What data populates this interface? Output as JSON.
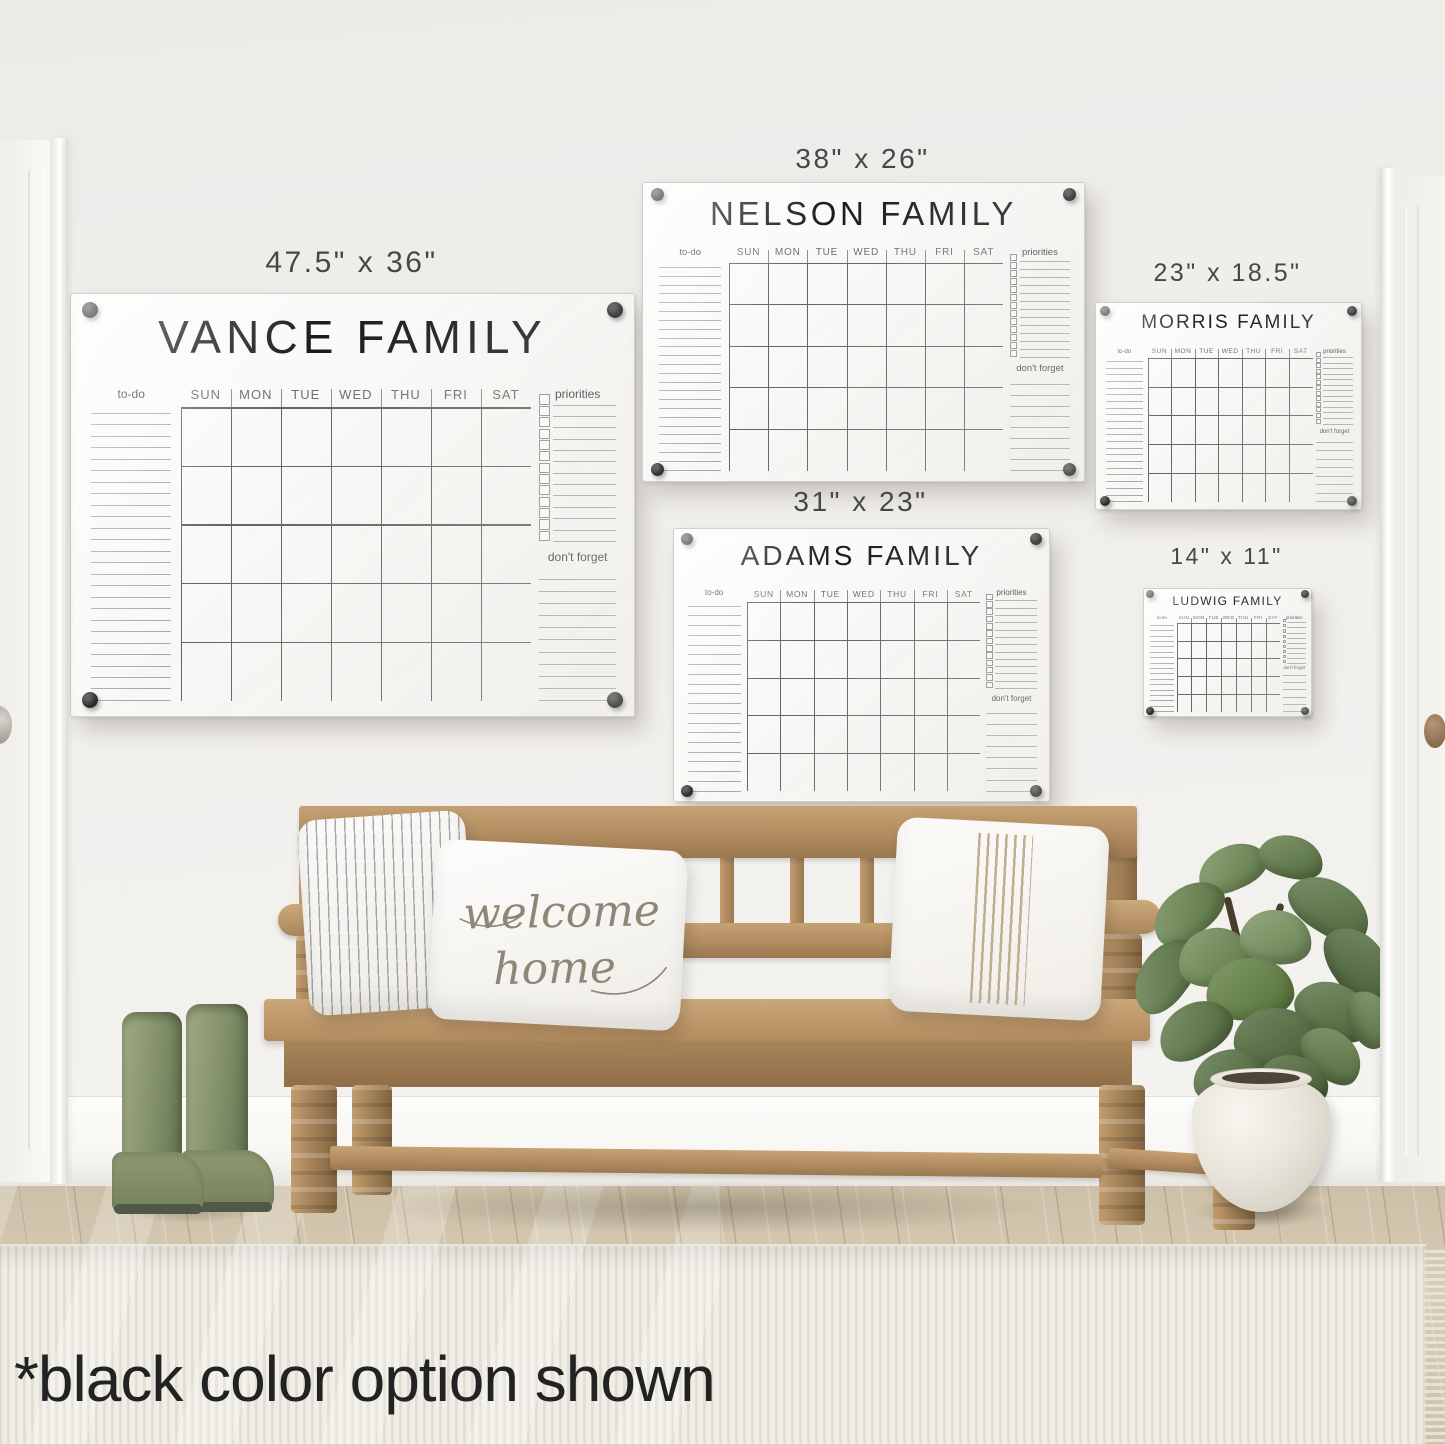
{
  "caption": "*black color option shown",
  "days": [
    "SUN",
    "MON",
    "TUE",
    "WED",
    "THU",
    "FRI",
    "SAT"
  ],
  "board_labels": {
    "todo": "to-do",
    "priorities": "priorities",
    "dont_forget": "don't forget"
  },
  "boards": [
    {
      "id": "vance",
      "title": "VANCE FAMILY",
      "size_label": "47.5\" x 36\"",
      "todo_lines": 26,
      "priority_rows": 13,
      "dont_forget_lines": 11
    },
    {
      "id": "nelson",
      "title": "NELSON FAMILY",
      "size_label": "38\" x 26\"",
      "todo_lines": 24,
      "priority_rows": 13,
      "dont_forget_lines": 9
    },
    {
      "id": "adams",
      "title": "ADAMS FAMILY",
      "size_label": "31\" x 23\"",
      "todo_lines": 20,
      "priority_rows": 13,
      "dont_forget_lines": 8
    },
    {
      "id": "morris",
      "title": "MORRIS FAMILY",
      "size_label": "23\" x 18.5\"",
      "todo_lines": 22,
      "priority_rows": 13,
      "dont_forget_lines": 8
    },
    {
      "id": "ludwig",
      "title": "LUDWIG FAMILY",
      "size_label": "14\" x 11\"",
      "todo_lines": 17,
      "priority_rows": 9,
      "dont_forget_lines": 6
    }
  ],
  "pillow_text": {
    "line1": "welcome",
    "line2": "home"
  },
  "colors": {
    "mount_hardware": "#161616",
    "calendar_text": "#1b1b1b",
    "wood": "#b08a5f",
    "boots_green": "#87936f",
    "plant_green": "#5e7a45",
    "wall": "#f1efec"
  }
}
